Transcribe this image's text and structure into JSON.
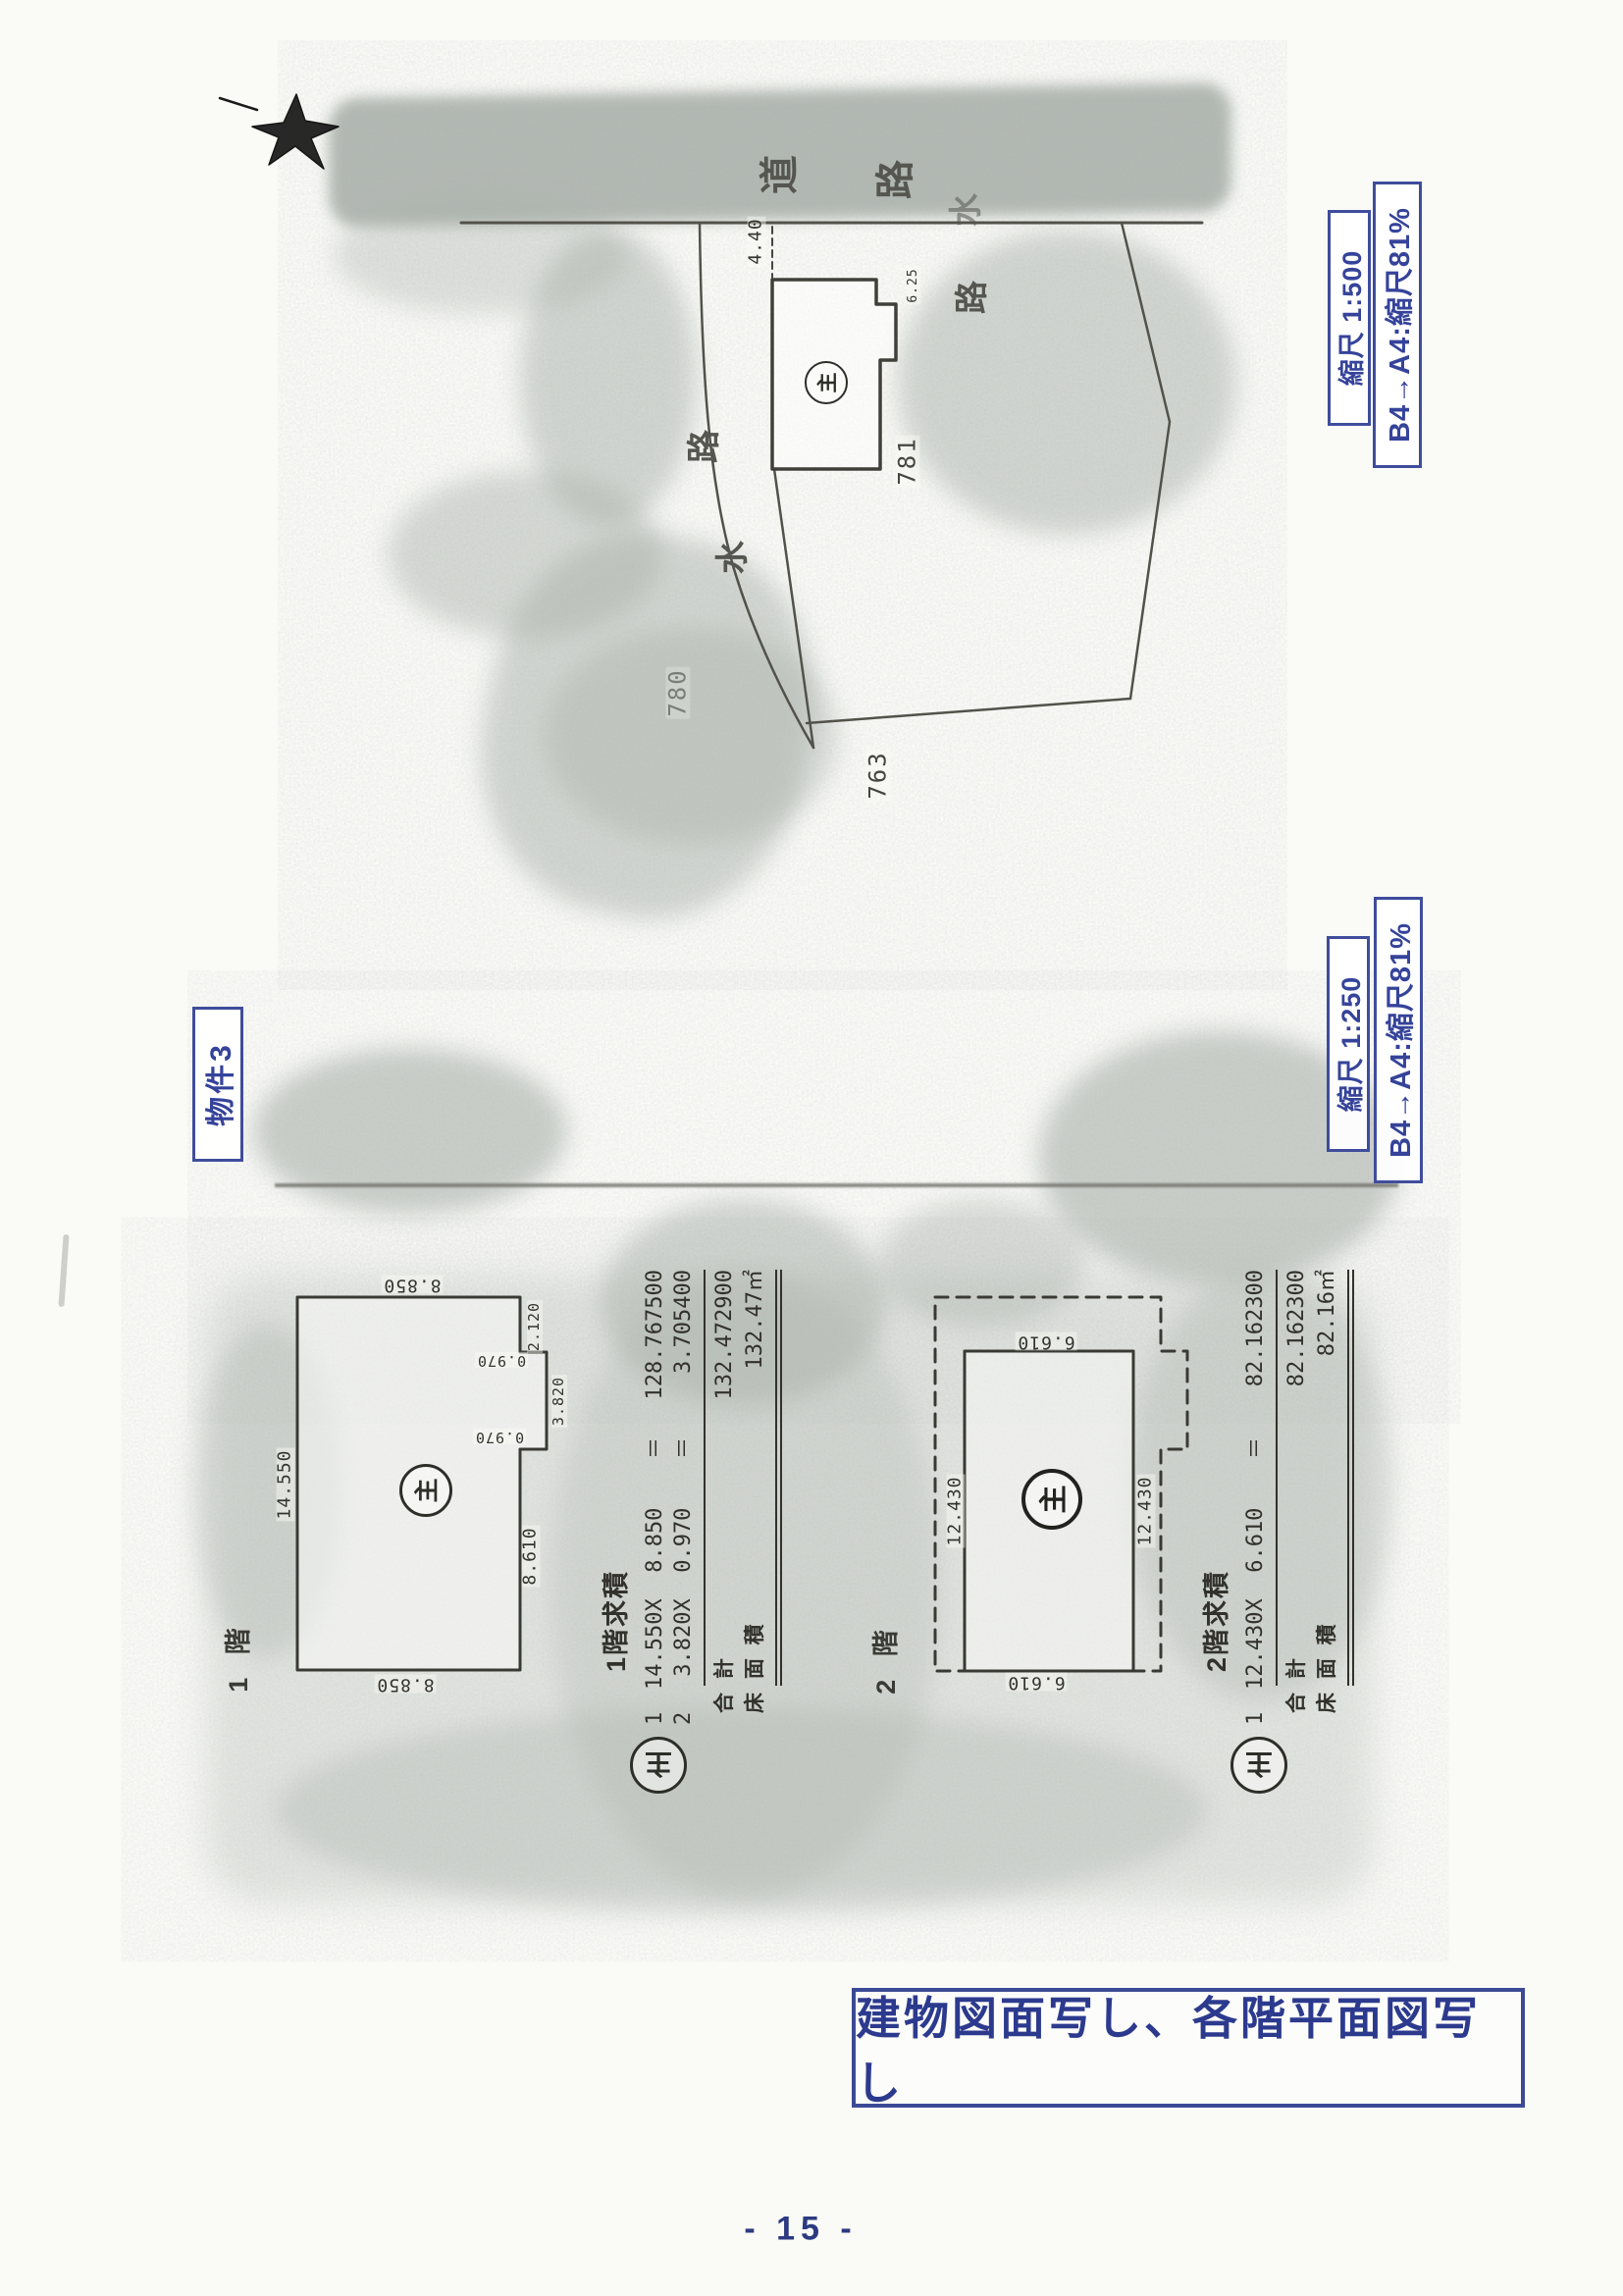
{
  "page": {
    "number": "- 15 -",
    "note": "建物図面写し、各階平面図写し"
  },
  "stamps": {
    "property": "物件3",
    "scale_top": "縮尺 1:500",
    "reduction_top": "B4→A4:縮尺81%",
    "scale_middle": "縮尺 1:250",
    "reduction_middle": "B4→A4:縮尺81%"
  },
  "site_map": {
    "road_char_1": "道",
    "road_char_2": "路",
    "waterway_left_char_1": "水",
    "waterway_left_char_2": "路",
    "waterway_right_char_1": "水",
    "waterway_right_char_2": "路",
    "lot_781": "781",
    "lot_780": "780",
    "lot_763": "763",
    "dim_setback": "4.40",
    "dim_frontage": "6.25",
    "building_mark": "主"
  },
  "floor1": {
    "name": "1 階",
    "mark": "主",
    "dim_top": "8.850",
    "dim_bottom": "8.850",
    "dim_left": "14.550",
    "dim_right_lower": "8.610",
    "notch_offset": "2.120",
    "notch_depth_top": "0.970",
    "notch_length": "3.820",
    "notch_depth_bottom": "0.970"
  },
  "floor2": {
    "name": "2 階",
    "mark": "主",
    "dim_top": "6.610",
    "dim_bottom": "6.610",
    "dim_left": "12.430",
    "dim_right": "12.430"
  },
  "calc1": {
    "mark": "主",
    "title": "1階求積",
    "rows": [
      {
        "no": "1",
        "formula": "14.550X  8.850",
        "eq": "＝",
        "value": "128.767500"
      },
      {
        "no": "2",
        "formula": " 3.820X  0.970",
        "eq": "＝",
        "value": "3.705400"
      }
    ],
    "total_label": "合  計",
    "total_value": "132.472900",
    "area_label": "床 面 積",
    "area_value": "132.47㎡"
  },
  "calc2": {
    "mark": "主",
    "title": "2階求積",
    "rows": [
      {
        "no": "1",
        "formula": "12.430X  6.610",
        "eq": "＝",
        "value": "82.162300"
      }
    ],
    "total_label": "合  計",
    "total_value": "82.162300",
    "area_label": "床 面 積",
    "area_value": "82.16㎡"
  }
}
